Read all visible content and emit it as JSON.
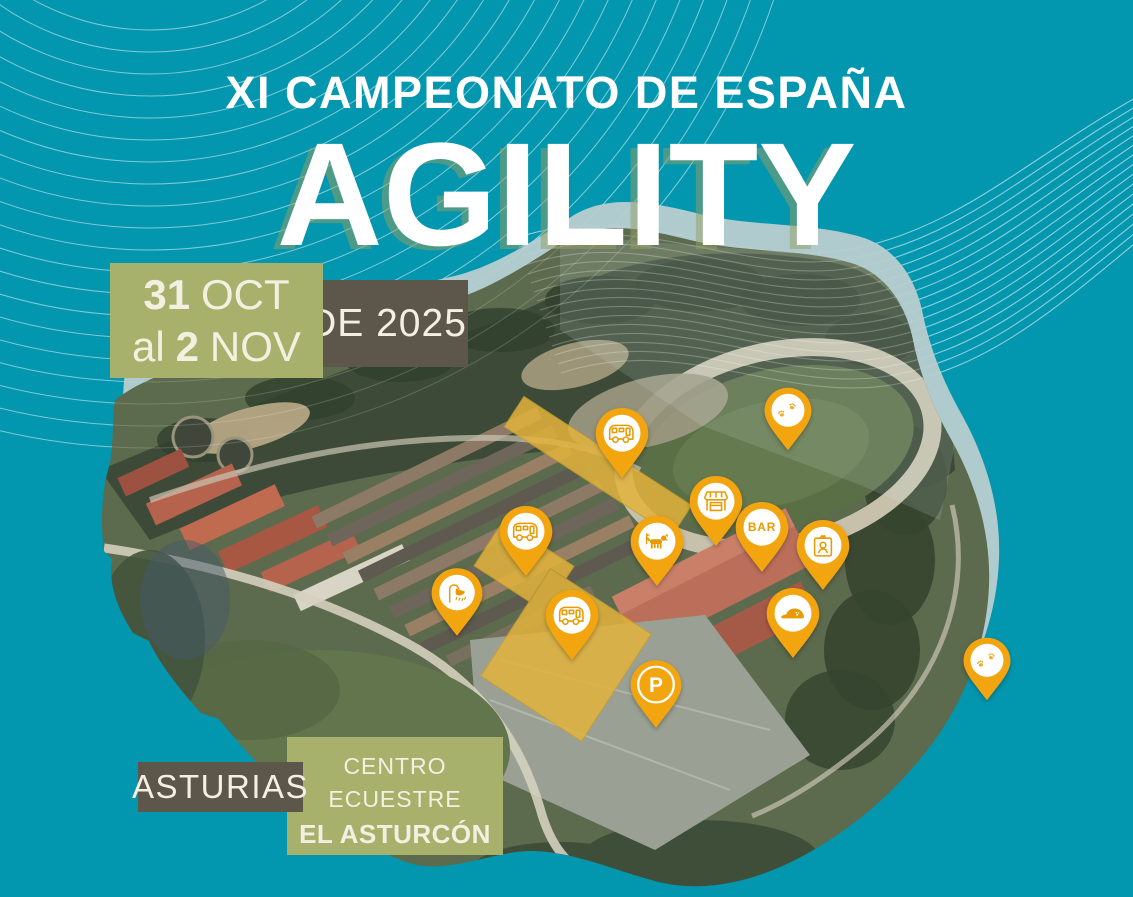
{
  "poster": {
    "supertitle": "XI CAMPEONATO DE ESPAÑA",
    "main_title": "AGILITY",
    "date_badge": {
      "day_start": "31",
      "month_start": "OCT",
      "connector": "al",
      "day_end": "2",
      "month_end": "NOV"
    },
    "year_badge": "DE 2025",
    "region_badge": "ASTURIAS",
    "venue_badge": {
      "line1": "CENTRO",
      "line2": "ECUESTRE",
      "line3": "EL ASTURCÓN"
    },
    "colors": {
      "background_teal": "#0396AF",
      "marker_orange": "#F2A50F",
      "marker_icon_orange": "#E89B00",
      "badge_olive": "#A7B16C",
      "badge_brown": "#5C564B",
      "highlight_yellow": "#E3B33C",
      "text_cream": "#F3F0E1"
    }
  },
  "map": {
    "subject": "Aerial view of equestrian center with location markers",
    "pins": [
      {
        "id": "paw-north",
        "icon": "paw",
        "x": 788,
        "y": 452,
        "w": 50,
        "h": 66
      },
      {
        "id": "caravan-north",
        "icon": "caravan",
        "x": 622,
        "y": 480,
        "w": 56,
        "h": 74
      },
      {
        "id": "kiosk",
        "icon": "kiosk",
        "x": 716,
        "y": 548,
        "w": 56,
        "h": 74
      },
      {
        "id": "bar",
        "icon": "bar",
        "label": "BAR",
        "x": 762,
        "y": 574,
        "w": 56,
        "h": 74
      },
      {
        "id": "accreditation",
        "icon": "id-card",
        "x": 823,
        "y": 592,
        "w": 56,
        "h": 74
      },
      {
        "id": "caravan-west",
        "icon": "caravan",
        "x": 526,
        "y": 578,
        "w": 56,
        "h": 74
      },
      {
        "id": "dog-agility",
        "icon": "dog",
        "x": 657,
        "y": 588,
        "w": 56,
        "h": 74
      },
      {
        "id": "showers",
        "icon": "shower",
        "x": 457,
        "y": 638,
        "w": 54,
        "h": 72
      },
      {
        "id": "caravan-south",
        "icon": "caravan",
        "x": 572,
        "y": 662,
        "w": 56,
        "h": 74
      },
      {
        "id": "cap",
        "icon": "cap",
        "x": 793,
        "y": 660,
        "w": 56,
        "h": 74
      },
      {
        "id": "parking",
        "icon": "parking",
        "label": "P",
        "x": 656,
        "y": 732,
        "w": 54,
        "h": 76
      },
      {
        "id": "paw-east",
        "icon": "paw",
        "x": 987,
        "y": 702,
        "w": 50,
        "h": 66
      }
    ]
  }
}
